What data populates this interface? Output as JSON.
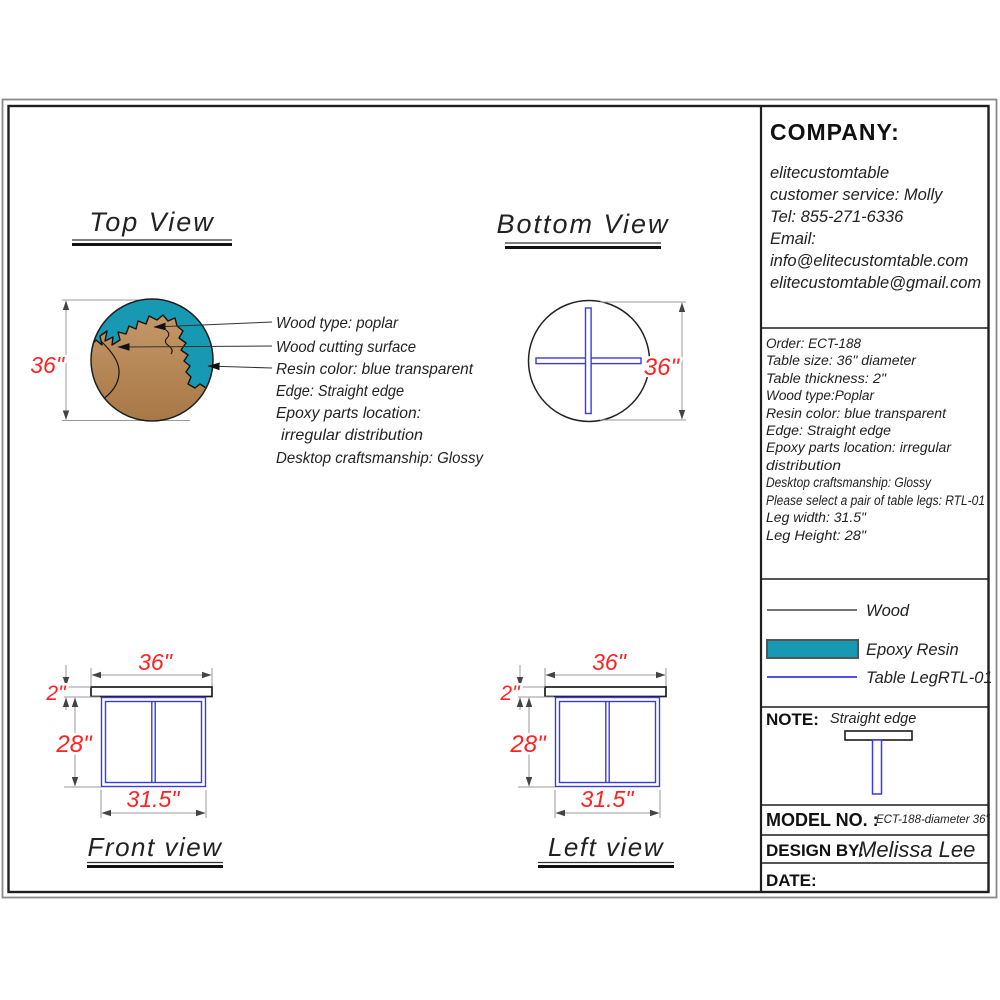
{
  "colors": {
    "epoxy_resin": "#1899B3",
    "table_leg_blue": "#3A3AE0",
    "dimension_red": "#FF2222",
    "wood_brown_light": "#C59768",
    "wood_brown_dark": "#A77744",
    "outline_black": "#1C1C1C",
    "dim_gray": "#999999"
  },
  "views": {
    "top": {
      "title": "Top View",
      "dim_diameter": "36\""
    },
    "bottom": {
      "title": "Bottom View",
      "dim_diameter": "36\""
    },
    "front": {
      "title": "Front view",
      "dim_width": "36\"",
      "dim_thickness": "2\"",
      "dim_leg_height": "28\"",
      "dim_leg_width": "31.5\""
    },
    "left": {
      "title": "Left view",
      "dim_width": "36\"",
      "dim_thickness": "2\"",
      "dim_leg_height": "28\"",
      "dim_leg_width": "31.5\""
    }
  },
  "annotations": [
    "Wood type: poplar",
    "Wood cutting surface",
    "Resin color: blue transparent",
    "Edge: Straight edge",
    "Epoxy parts location:",
    "irregular distribution",
    "Desktop craftsmanship: Glossy"
  ],
  "company": {
    "heading": "COMPANY:",
    "lines": [
      "elitecustomtable",
      "customer service: Molly",
      "Tel: 855-271-6336",
      "Email:",
      "info@elitecustomtable.com",
      "elitecustomtable@gmail.com"
    ]
  },
  "order": {
    "lines": [
      "Order: ECT-188",
      "Table size: 36\" diameter",
      "Table thickness: 2\"",
      "Wood type:Poplar",
      "Resin color: blue transparent",
      "Edge: Straight edge",
      "Epoxy parts location: irregular",
      "distribution",
      "Desktop craftsmanship: Glossy",
      "Please select a pair of table legs: RTL-01",
      "Leg width: 31.5\"",
      "Leg Height: 28\""
    ]
  },
  "legend": {
    "items": [
      {
        "label": "Wood"
      },
      {
        "label": "Epoxy Resin",
        "color": "#1899B3"
      },
      {
        "label": "Table LegRTL-01",
        "color": "#3A3AE0"
      }
    ]
  },
  "note": {
    "heading": "NOTE:",
    "text": "Straight edge"
  },
  "title_block": {
    "model_label": "MODEL NO. :",
    "model_value": "ECT-188-diameter 36\"",
    "design_label": "DESIGN BY:",
    "design_value": "Melissa Lee",
    "date_label": "DATE:"
  }
}
